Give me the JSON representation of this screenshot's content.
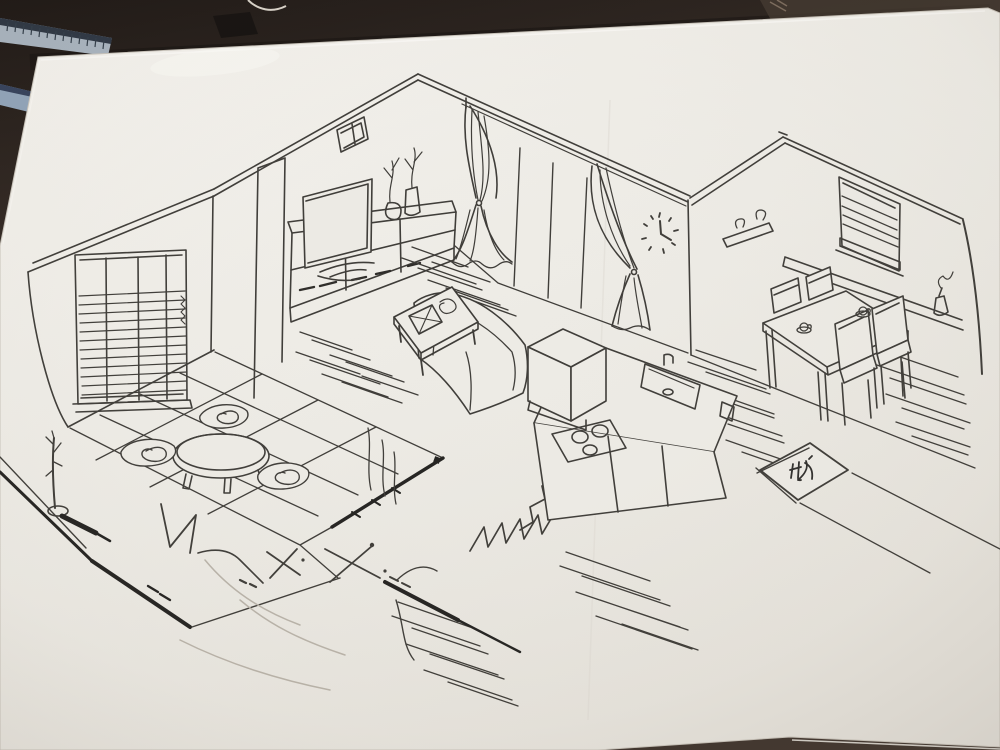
{
  "scene": {
    "mat_kanji": "収",
    "clock_time_hint": "hands at 12 and 4"
  },
  "colors": {
    "table_wood_dark": "#241c18",
    "table_wood_mid": "#3b2f28",
    "paper_white": "#f0eee9",
    "paper_shade": "#e7e4de",
    "pen_ink": "#3e3c38",
    "pen_ink_bold": "#232220",
    "ruler_steel": "#a7b2bd",
    "ruler_stripe": "#2c3542",
    "pencil_smudge": "#b9b3a9"
  }
}
